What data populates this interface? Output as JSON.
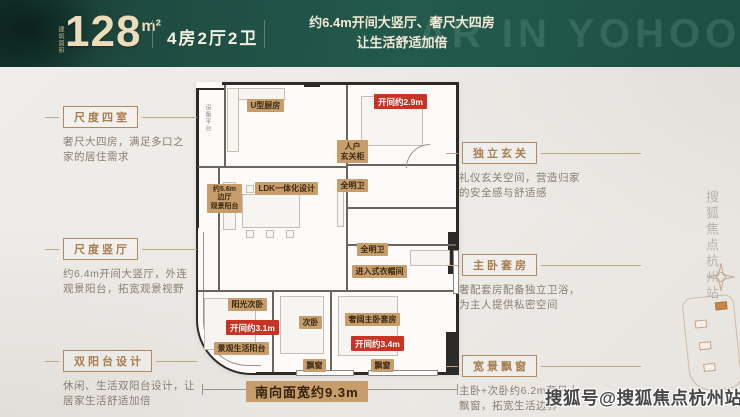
{
  "header": {
    "area_label": "建筑面积",
    "area_value": "128",
    "area_unit": "m²",
    "layout": "4房2厅2卫",
    "tagline_line1": "约6.4m开间大竖厅、奢尺大四房",
    "tagline_line2": "让生活舒适加倍",
    "ghost_text": "AR IN YOHOO",
    "bg_color": "#1e4a40",
    "accent_color": "#ecdcba"
  },
  "callouts": {
    "title_color": "#a87d50",
    "desc_color": "#8a7d70",
    "left": [
      {
        "title": "尺度四室",
        "desc_line1": "奢尺大四房，满足多口之",
        "desc_line2": "家的居住需求"
      },
      {
        "title": "尺度竖厅",
        "desc_line1": "约6.4m开间大竖厅，外连",
        "desc_line2": "观景阳台，拓宽观景视野"
      },
      {
        "title": "双阳台设计",
        "desc_line1": "休闲、生活双阳台设计，让",
        "desc_line2": "居家生活舒适加倍"
      }
    ],
    "right": [
      {
        "title": "独立玄关",
        "desc_line1": "礼仪玄关空间，营造归家",
        "desc_line2": "的安全感与舒适感"
      },
      {
        "title": "主卧套房",
        "desc_line1": "奢配套房配备独立卫浴，",
        "desc_line2": "为主人提供私密空间"
      },
      {
        "title": "宽景飘窗",
        "desc_line1": "主卧+次卧约6.2m奢尺大",
        "desc_line2": "飘窗，拓宽生活边界"
      }
    ]
  },
  "floorplan": {
    "label_bg": "#c79d6b",
    "red_bg": "#c63523",
    "labels": {
      "equip_platform": "设备平台",
      "kitchen": "U型厨房",
      "entry_line1": "人户",
      "entry_line2": "玄关柜",
      "bath1": "全明卫",
      "ldk": "LDK一体化设计",
      "side_hall_line1": "约5.6m",
      "side_hall_line2": "边厅",
      "side_hall_line3": "观景阳台",
      "bath2": "全明卫",
      "walkin_closet": "进入式衣帽间",
      "sun_bedroom": "阳光次卧",
      "bedroom2": "次卧",
      "master": "奢阔主卧套房",
      "view_balcony": "景观生活阳台",
      "bay1": "飘窗",
      "bay2": "飘窗",
      "dim_29": "开间约2.9m",
      "dim_31": "开间约3.1m",
      "dim_34": "开间约3.4m"
    },
    "south_width": "南向面宽约9.3m"
  },
  "watermarks": {
    "bottom": "搜狐号@搜狐焦点杭州站",
    "side_vertical": "搜狐焦点杭州站"
  }
}
